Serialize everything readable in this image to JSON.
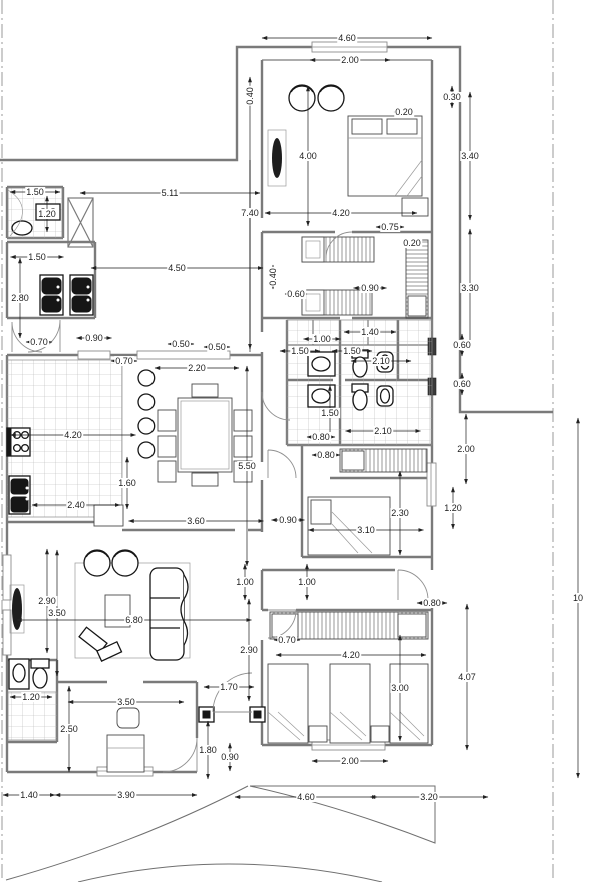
{
  "colors": {
    "wall": "#7a7a7a",
    "dim": "#1c1c1c",
    "door": "#8f8f8f",
    "site": "#9a9a9a",
    "fix": "#161616"
  },
  "dimensions": [
    {
      "label": "4.60",
      "x": 347,
      "y": 38,
      "o": "h",
      "len": 170
    },
    {
      "label": "2.00",
      "x": 350,
      "y": 60,
      "o": "h",
      "len": 80
    },
    {
      "label": "0.30",
      "x": 452,
      "y": 97,
      "o": "v",
      "len": 22
    },
    {
      "label": "0.20",
      "x": 404,
      "y": 112,
      "o": "h",
      "len": 20
    },
    {
      "label": "0.40",
      "x": 250,
      "y": 96,
      "o": "v",
      "len": 20,
      "rot": 1
    },
    {
      "label": "4.00",
      "x": 308,
      "y": 156,
      "o": "v",
      "len": 140
    },
    {
      "label": "3.40",
      "x": 470,
      "y": 156,
      "o": "v",
      "len": 128
    },
    {
      "label": "7.40",
      "x": 250,
      "y": 213,
      "o": "v",
      "len": 272
    },
    {
      "label": "5.11",
      "x": 170,
      "y": 193,
      "o": "h",
      "len": 180
    },
    {
      "label": "1.50",
      "x": 35,
      "y": 192,
      "o": "h",
      "len": 50
    },
    {
      "label": "1.20",
      "x": 47,
      "y": 214,
      "o": "v",
      "len": 36
    },
    {
      "label": "1.50",
      "x": 37,
      "y": 257,
      "o": "h",
      "len": 53
    },
    {
      "label": "2.80",
      "x": 20,
      "y": 298,
      "o": "v",
      "len": 80
    },
    {
      "label": "4.50",
      "x": 177,
      "y": 268,
      "o": "h",
      "len": 172
    },
    {
      "label": "0.40",
      "x": 273,
      "y": 277,
      "o": "v",
      "len": 24,
      "rot": 1
    },
    {
      "label": "4.20",
      "x": 341,
      "y": 213,
      "o": "h",
      "len": 152
    },
    {
      "label": "0.75",
      "x": 390,
      "y": 227,
      "o": "h",
      "len": 28
    },
    {
      "label": "0.20",
      "x": 412,
      "y": 243,
      "o": "h",
      "len": 16
    },
    {
      "label": "0.90",
      "x": 370,
      "y": 288,
      "o": "h",
      "len": 33
    },
    {
      "label": "3.30",
      "x": 470,
      "y": 288,
      "o": "v",
      "len": 118
    },
    {
      "label": "0.60",
      "x": 296,
      "y": 294,
      "o": "h",
      "len": 22
    },
    {
      "label": "0.60",
      "x": 462,
      "y": 345,
      "o": "v",
      "len": 22
    },
    {
      "label": "0.60",
      "x": 462,
      "y": 384,
      "o": "v",
      "len": 22
    },
    {
      "label": "1.40",
      "x": 370,
      "y": 332,
      "o": "h",
      "len": 52
    },
    {
      "label": "1.00",
      "x": 322,
      "y": 339,
      "o": "h",
      "len": 37
    },
    {
      "label": "1.50",
      "x": 300,
      "y": 351,
      "o": "h",
      "len": 40
    },
    {
      "label": "1.50",
      "x": 352,
      "y": 351,
      "o": "h",
      "len": 40
    },
    {
      "label": "2.10",
      "x": 381,
      "y": 361,
      "o": "h",
      "len": 60
    },
    {
      "label": "1.50",
      "x": 330,
      "y": 413,
      "o": "v",
      "len": 55
    },
    {
      "label": "2.10",
      "x": 383,
      "y": 431,
      "o": "h",
      "len": 75
    },
    {
      "label": "0.80",
      "x": 321,
      "y": 437,
      "o": "h",
      "len": 28
    },
    {
      "label": "0.80",
      "x": 326,
      "y": 455,
      "o": "h",
      "len": 28
    },
    {
      "label": "0.90",
      "x": 94,
      "y": 338,
      "o": "h",
      "len": 35
    },
    {
      "label": "0.50",
      "x": 181,
      "y": 344,
      "o": "h",
      "len": 26
    },
    {
      "label": "0.50",
      "x": 217,
      "y": 347,
      "o": "h",
      "len": 26
    },
    {
      "label": "0.70",
      "x": 39,
      "y": 342,
      "o": "h",
      "len": 26
    },
    {
      "label": "0.70",
      "x": 124,
      "y": 361,
      "o": "h",
      "len": 26
    },
    {
      "label": "2.20",
      "x": 197,
      "y": 368,
      "o": "h",
      "len": 84
    },
    {
      "label": "4.20",
      "x": 73,
      "y": 435,
      "o": "h",
      "len": 125
    },
    {
      "label": "1.60",
      "x": 127,
      "y": 483,
      "o": "v",
      "len": 52
    },
    {
      "label": "2.40",
      "x": 76,
      "y": 505,
      "o": "h",
      "len": 88
    },
    {
      "label": "5.50",
      "x": 247,
      "y": 466,
      "o": "v",
      "len": 200
    },
    {
      "label": "3.60",
      "x": 196,
      "y": 521,
      "o": "h",
      "len": 135
    },
    {
      "label": "0.90",
      "x": 288,
      "y": 520,
      "o": "h",
      "len": 33
    },
    {
      "label": "2.30",
      "x": 400,
      "y": 513,
      "o": "v",
      "len": 84
    },
    {
      "label": "3.10",
      "x": 366,
      "y": 530,
      "o": "h",
      "len": 115
    },
    {
      "label": "1.20",
      "x": 453,
      "y": 508,
      "o": "v",
      "len": 42
    },
    {
      "label": "2.00",
      "x": 466,
      "y": 449,
      "o": "v",
      "len": 70
    },
    {
      "label": "1.00",
      "x": 245,
      "y": 582,
      "o": "v",
      "len": 36
    },
    {
      "label": "1.00",
      "x": 307,
      "y": 582,
      "o": "v",
      "len": 36
    },
    {
      "label": "0.80",
      "x": 432,
      "y": 603,
      "o": "h",
      "len": 30
    },
    {
      "label": "2.90",
      "x": 47,
      "y": 601,
      "o": "v",
      "len": 104
    },
    {
      "label": "3.50",
      "x": 57,
      "y": 613,
      "o": "v",
      "len": 126
    },
    {
      "label": "6.80",
      "x": 134,
      "y": 620,
      "o": "h",
      "len": 235
    },
    {
      "label": "0.70",
      "x": 287,
      "y": 640,
      "o": "h",
      "len": 26
    },
    {
      "label": "2.90",
      "x": 249,
      "y": 650,
      "o": "v",
      "len": 102
    },
    {
      "label": "4.20",
      "x": 351,
      "y": 655,
      "o": "h",
      "len": 150
    },
    {
      "label": "3.00",
      "x": 400,
      "y": 688,
      "o": "v",
      "len": 106
    },
    {
      "label": "4.07",
      "x": 467,
      "y": 677,
      "o": "v",
      "len": 146
    },
    {
      "label": "2.00",
      "x": 350,
      "y": 761,
      "o": "h",
      "len": 76
    },
    {
      "label": "1.70",
      "x": 229,
      "y": 687,
      "o": "h",
      "len": 50
    },
    {
      "label": "3.50",
      "x": 126,
      "y": 702,
      "o": "h",
      "len": 116
    },
    {
      "label": "1.20",
      "x": 31,
      "y": 697,
      "o": "h",
      "len": 42
    },
    {
      "label": "2.50",
      "x": 69,
      "y": 729,
      "o": "v",
      "len": 86
    },
    {
      "label": "1.80",
      "x": 208,
      "y": 750,
      "o": "v",
      "len": 58
    },
    {
      "label": "0.90",
      "x": 230,
      "y": 757,
      "o": "v",
      "len": 28
    },
    {
      "label": "1.40",
      "x": 29,
      "y": 795,
      "o": "h",
      "len": 52
    },
    {
      "label": "3.90",
      "x": 126,
      "y": 795,
      "o": "h",
      "len": 142
    },
    {
      "label": "4.60",
      "x": 306,
      "y": 797,
      "o": "h",
      "len": 142
    },
    {
      "label": "3.20",
      "x": 429,
      "y": 797,
      "o": "h",
      "len": 118
    },
    {
      "label": "10",
      "x": 578,
      "y": 598,
      "o": "v",
      "len": 360
    }
  ]
}
